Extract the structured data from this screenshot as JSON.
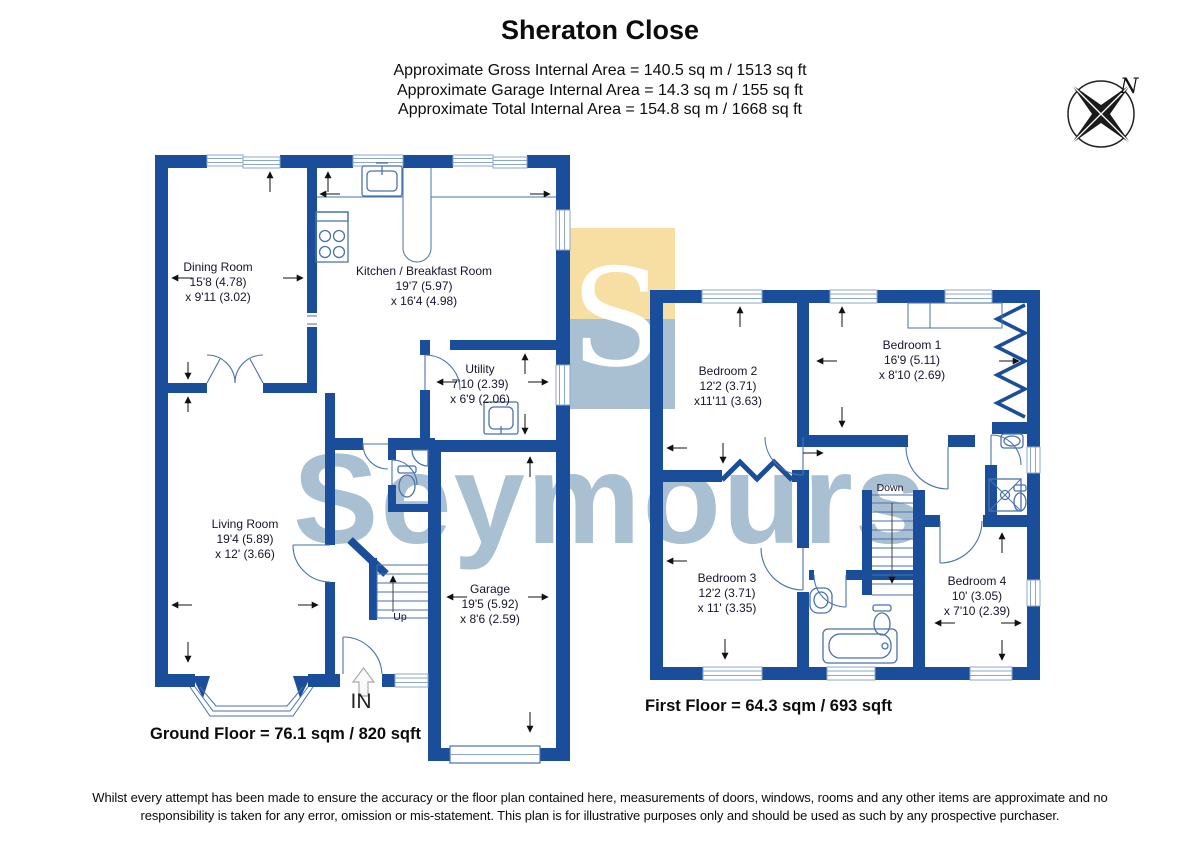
{
  "header": {
    "title": "Sheraton Close",
    "area_lines": [
      "Approximate Gross Internal Area = 140.5 sq m / 1513 sq ft",
      "Approximate Garage Internal Area = 14.3 sq m / 155 sq ft",
      "Approximate Total Internal Area = 154.8 sq m / 1668 sq ft"
    ]
  },
  "compass": {
    "north_label": "N"
  },
  "watermark": {
    "logo_letter": "S",
    "brand": "Seymours"
  },
  "ground_floor": {
    "caption": "Ground Floor = 76.1 sqm / 820 sqft",
    "entrance_label": "IN",
    "stairs_label": "Up",
    "rooms": {
      "dining": {
        "name": "Dining Room",
        "dim1": "15'8 (4.78)",
        "dim2": "x 9'11 (3.02)"
      },
      "kitchen": {
        "name": "Kitchen / Breakfast Room",
        "dim1": "19'7 (5.97)",
        "dim2": "x 16'4 (4.98)"
      },
      "utility": {
        "name": "Utility",
        "dim1": "7'10 (2.39)",
        "dim2": "x 6'9 (2.06)"
      },
      "living": {
        "name": "Living Room",
        "dim1": "19'4 (5.89)",
        "dim2": "x 12' (3.66)"
      },
      "garage": {
        "name": "Garage",
        "dim1": "19'5 (5.92)",
        "dim2": "x 8'6 (2.59)"
      }
    }
  },
  "first_floor": {
    "caption": "First Floor = 64.3 sqm / 693 sqft",
    "stairs_label": "Down",
    "rooms": {
      "bedroom1": {
        "name": "Bedroom 1",
        "dim1": "16'9 (5.11)",
        "dim2": "x 8'10 (2.69)"
      },
      "bedroom2": {
        "name": "Bedroom 2",
        "dim1": "12'2 (3.71)",
        "dim2": "x11'11 (3.63)"
      },
      "bedroom3": {
        "name": "Bedroom 3",
        "dim1": "12'2 (3.71)",
        "dim2": "x 11' (3.35)"
      },
      "bedroom4": {
        "name": "Bedroom 4",
        "dim1": "10' (3.05)",
        "dim2": "x 7'10 (2.39)"
      }
    }
  },
  "footer": {
    "line1": "Whilst every attempt has been made to ensure the accuracy or the floor plan contained here, measurements of doors, windows, rooms and any other items are approximate and no",
    "line2": "responsibility is taken for any error, omission or mis-statement. This plan is for illustrative purposes only and should be used as such by any prospective purchaser."
  },
  "colors": {
    "wall": "#1B4E9A",
    "fixture_line": "#4A72AD",
    "watermark": "#A9BFD2",
    "logo_yellow": "#F7DFA3",
    "arrow": "#111111"
  }
}
